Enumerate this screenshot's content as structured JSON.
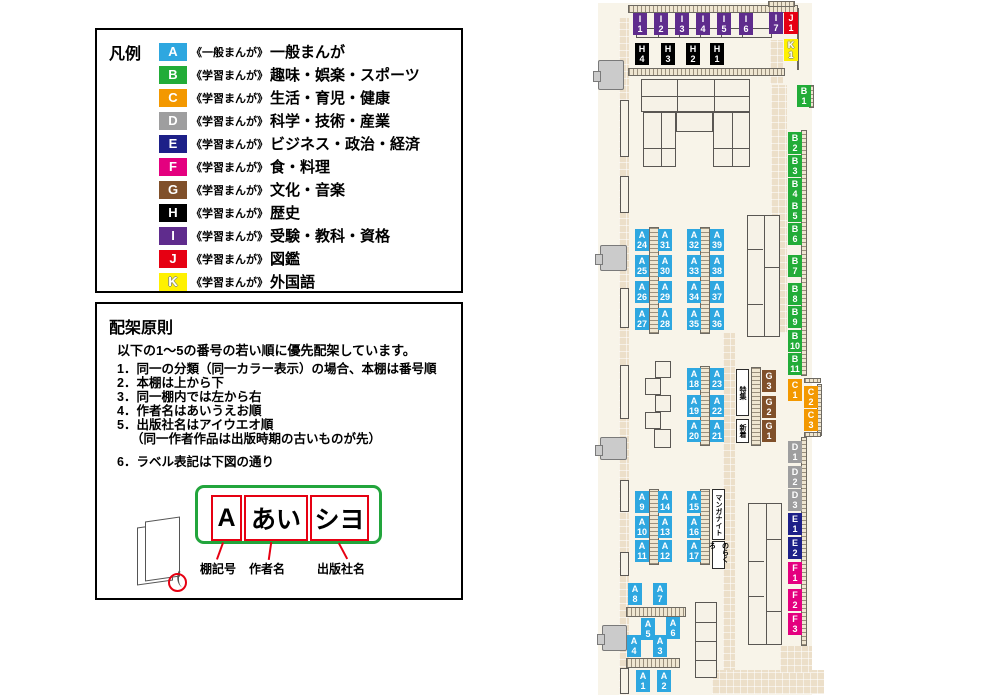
{
  "legend": {
    "title": "凡例",
    "items": [
      {
        "code": "A",
        "color": "#2EA7E0",
        "series": "《一般まんが》",
        "category": "一般まんが"
      },
      {
        "code": "B",
        "color": "#22AC38",
        "series": "《学習まんが》",
        "category": "趣味・娯楽・スポーツ"
      },
      {
        "code": "C",
        "color": "#F39800",
        "series": "《学習まんが》",
        "category": "生活・育児・健康"
      },
      {
        "code": "D",
        "color": "#9E9E9F",
        "series": "《学習まんが》",
        "category": "科学・技術・産業"
      },
      {
        "code": "E",
        "color": "#1D2088",
        "series": "《学習まんが》",
        "category": "ビジネス・政治・経済"
      },
      {
        "code": "F",
        "color": "#E4007F",
        "series": "《学習まんが》",
        "category": "食・料理"
      },
      {
        "code": "G",
        "color": "#80502A",
        "series": "《学習まんが》",
        "category": "文化・音楽"
      },
      {
        "code": "H",
        "color": "#000000",
        "series": "《学習まんが》",
        "category": "歴史"
      },
      {
        "code": "I",
        "color": "#5F2C8D",
        "series": "《学習まんが》",
        "category": "受験・教科・資格"
      },
      {
        "code": "J",
        "color": "#E60012",
        "series": "《学習まんが》",
        "category": "図鑑"
      },
      {
        "code": "K",
        "color": "#FFF100",
        "series": "《学習まんが》",
        "category": "外国語"
      }
    ]
  },
  "principles": {
    "title": "配架原則",
    "intro": "以下の1～5の番号の若い順に優先配架しています。",
    "rules": [
      {
        "text": "1．同一の分類（同一カラー表示）の場合、本棚は番号順"
      },
      {
        "text": "2．本棚は上から下"
      },
      {
        "text": "3．同一棚内では左から右"
      },
      {
        "text": "4．作者名はあいうえお順"
      },
      {
        "text": "5．出版社名はアイウエオ順"
      },
      {
        "text": "（同一作者作品は出版時期の古いものが先）",
        "indent": true
      },
      {
        "text": "6．ラベル表記は下図の通り",
        "gap": true
      }
    ],
    "label_diagram": {
      "boxes": [
        "A",
        "あい",
        "シヨ"
      ],
      "captions": [
        "棚記号",
        "作者名",
        "出版社名"
      ]
    }
  },
  "map": {
    "colors": {
      "A": "#2EA7E0",
      "B": "#22AC38",
      "C": "#F39800",
      "D": "#9E9E9F",
      "E": "#1D2088",
      "F": "#E4007F",
      "G": "#80502A",
      "H": "#000000",
      "I": "#5F2C8D",
      "J": "#E60012",
      "K": "#FFF100"
    },
    "shelf_labels": [
      {
        "id": "I1",
        "x": 633,
        "y": 13
      },
      {
        "id": "I2",
        "x": 654,
        "y": 13
      },
      {
        "id": "I3",
        "x": 675,
        "y": 13
      },
      {
        "id": "I4",
        "x": 696,
        "y": 13
      },
      {
        "id": "I5",
        "x": 717,
        "y": 13
      },
      {
        "id": "I6",
        "x": 739,
        "y": 13
      },
      {
        "id": "I7",
        "x": 769,
        "y": 12
      },
      {
        "id": "J1",
        "x": 784,
        "y": 12
      },
      {
        "id": "K1",
        "x": 784,
        "y": 39
      },
      {
        "id": "H4",
        "x": 635,
        "y": 43
      },
      {
        "id": "H3",
        "x": 661,
        "y": 43
      },
      {
        "id": "H2",
        "x": 686,
        "y": 43
      },
      {
        "id": "H1",
        "x": 710,
        "y": 43
      },
      {
        "id": "B1",
        "x": 797,
        "y": 85
      },
      {
        "id": "B2",
        "x": 788,
        "y": 132
      },
      {
        "id": "B3",
        "x": 788,
        "y": 155
      },
      {
        "id": "B4",
        "x": 788,
        "y": 178
      },
      {
        "id": "B5",
        "x": 788,
        "y": 200
      },
      {
        "id": "B6",
        "x": 788,
        "y": 223
      },
      {
        "id": "B7",
        "x": 788,
        "y": 255
      },
      {
        "id": "B8",
        "x": 788,
        "y": 283
      },
      {
        "id": "B9",
        "x": 788,
        "y": 306
      },
      {
        "id": "B10",
        "x": 788,
        "y": 330
      },
      {
        "id": "B11",
        "x": 788,
        "y": 353
      },
      {
        "id": "C1",
        "x": 788,
        "y": 379
      },
      {
        "id": "C2",
        "x": 804,
        "y": 386
      },
      {
        "id": "C3",
        "x": 804,
        "y": 409
      },
      {
        "id": "D1",
        "x": 788,
        "y": 441
      },
      {
        "id": "D2",
        "x": 788,
        "y": 466
      },
      {
        "id": "D3",
        "x": 788,
        "y": 489
      },
      {
        "id": "E1",
        "x": 788,
        "y": 513
      },
      {
        "id": "E2",
        "x": 788,
        "y": 537
      },
      {
        "id": "F1",
        "x": 788,
        "y": 562
      },
      {
        "id": "F2",
        "x": 788,
        "y": 589
      },
      {
        "id": "F3",
        "x": 788,
        "y": 613
      },
      {
        "id": "G3",
        "x": 762,
        "y": 370
      },
      {
        "id": "G2",
        "x": 762,
        "y": 396
      },
      {
        "id": "G1",
        "x": 762,
        "y": 420
      },
      {
        "id": "A24",
        "x": 635,
        "y": 229
      },
      {
        "id": "A25",
        "x": 635,
        "y": 255
      },
      {
        "id": "A26",
        "x": 635,
        "y": 281
      },
      {
        "id": "A27",
        "x": 635,
        "y": 308
      },
      {
        "id": "A28",
        "x": 658,
        "y": 308
      },
      {
        "id": "A29",
        "x": 658,
        "y": 281
      },
      {
        "id": "A30",
        "x": 658,
        "y": 255
      },
      {
        "id": "A31",
        "x": 658,
        "y": 229
      },
      {
        "id": "A32",
        "x": 687,
        "y": 229
      },
      {
        "id": "A33",
        "x": 687,
        "y": 255
      },
      {
        "id": "A34",
        "x": 687,
        "y": 281
      },
      {
        "id": "A35",
        "x": 687,
        "y": 308
      },
      {
        "id": "A36",
        "x": 710,
        "y": 308
      },
      {
        "id": "A37",
        "x": 710,
        "y": 281
      },
      {
        "id": "A38",
        "x": 710,
        "y": 255
      },
      {
        "id": "A39",
        "x": 710,
        "y": 229
      },
      {
        "id": "A18",
        "x": 687,
        "y": 368
      },
      {
        "id": "A19",
        "x": 687,
        "y": 395
      },
      {
        "id": "A20",
        "x": 687,
        "y": 420
      },
      {
        "id": "A21",
        "x": 710,
        "y": 420
      },
      {
        "id": "A22",
        "x": 710,
        "y": 395
      },
      {
        "id": "A23",
        "x": 710,
        "y": 368
      },
      {
        "id": "A9",
        "x": 635,
        "y": 491
      },
      {
        "id": "A10",
        "x": 635,
        "y": 516
      },
      {
        "id": "A11",
        "x": 635,
        "y": 540
      },
      {
        "id": "A12",
        "x": 658,
        "y": 540
      },
      {
        "id": "A13",
        "x": 658,
        "y": 516
      },
      {
        "id": "A14",
        "x": 658,
        "y": 491
      },
      {
        "id": "A15",
        "x": 687,
        "y": 491
      },
      {
        "id": "A16",
        "x": 687,
        "y": 516
      },
      {
        "id": "A17",
        "x": 687,
        "y": 540
      },
      {
        "id": "A8",
        "x": 628,
        "y": 583
      },
      {
        "id": "A7",
        "x": 653,
        "y": 583
      },
      {
        "id": "A5",
        "x": 641,
        "y": 618
      },
      {
        "id": "A6",
        "x": 666,
        "y": 617
      },
      {
        "id": "A4",
        "x": 627,
        "y": 635
      },
      {
        "id": "A3",
        "x": 653,
        "y": 635
      },
      {
        "id": "A1",
        "x": 636,
        "y": 670
      },
      {
        "id": "A2",
        "x": 657,
        "y": 670
      }
    ],
    "text_shelves": [
      {
        "text": "特集",
        "x": 736,
        "y": 369,
        "h": 47
      },
      {
        "text": "新着",
        "x": 736,
        "y": 419,
        "h": 24
      },
      {
        "text": "マンガナイト",
        "x": 712,
        "y": 489,
        "h": 51
      },
      {
        "text": "のらくろ",
        "x": 712,
        "y": 541,
        "h": 28
      }
    ]
  }
}
